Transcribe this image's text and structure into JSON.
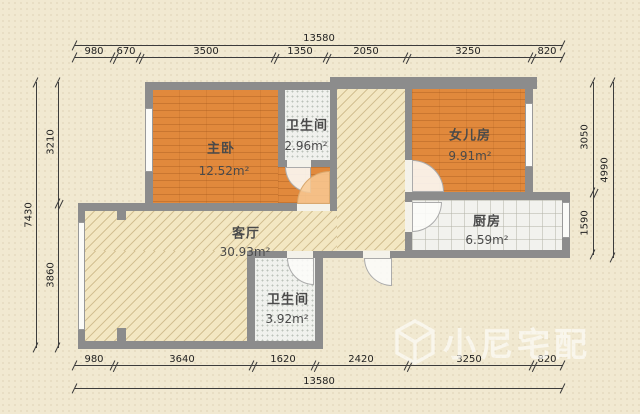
{
  "title": "apartment-floor-plan",
  "rooms": [
    {
      "name": "主卧",
      "area": "12.52m²"
    },
    {
      "name": "卫生间",
      "area": "2.96m²"
    },
    {
      "name": "女儿房",
      "area": "9.91m²"
    },
    {
      "name": "厨房",
      "area": "6.59m²"
    },
    {
      "name": "客厅",
      "area": "30.93m²"
    },
    {
      "name": "卫生间",
      "area": "3.92m²"
    }
  ],
  "dimensions": {
    "top_total": "13580",
    "top_segments": [
      "980",
      "670",
      "3500",
      "1350",
      "2050",
      "3250",
      "820"
    ],
    "bottom_total": "13580",
    "bottom_segments": [
      "980",
      "3640",
      "1620",
      "2420",
      "3250",
      "820"
    ],
    "left_total": "7430",
    "left_segments": [
      "3210",
      "3860"
    ],
    "right_total": "4990",
    "right_segments": [
      "3050",
      "1590"
    ]
  },
  "watermark": {
    "brand": "小尼宅配"
  },
  "colors": {
    "wall": "#8c8c8c",
    "wood_floor": "#e1893c",
    "tile_floor": "#f2f2ee",
    "living_floor": "#f3e7c2",
    "background": "#f1e9d1"
  }
}
